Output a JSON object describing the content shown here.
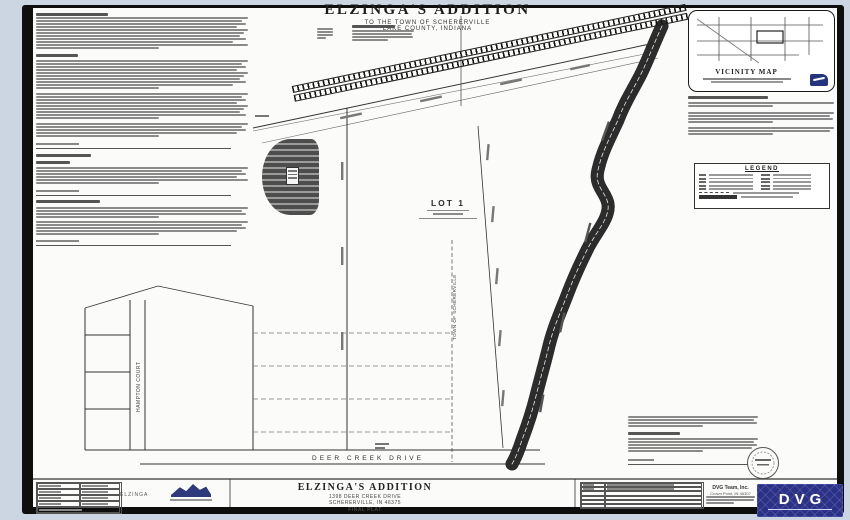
{
  "header": {
    "title": "ELZINGA'S ADDITION",
    "sub1": "TO THE TOWN OF SCHERERVILLE",
    "sub2": "LAKE COUNTY, INDIANA"
  },
  "vicinity": {
    "caption": "VICINITY MAP"
  },
  "legend": {
    "title": "LEGEND",
    "rows_two_col": 5,
    "sample_rows": [
      "dashed-line",
      "solid-bar",
      "symbol-note"
    ]
  },
  "map": {
    "lot1": "LOT 1",
    "town_label": "TOWN OF SCHERERVILLE",
    "hampton": "HAMPTON COURT",
    "deer_creek_drive": "DEER CREEK DRIVE"
  },
  "title_block": {
    "name": "ELZINGA'S ADDITION",
    "address": "1398 DEER CREEK DRIVE",
    "city": "SCHERERVILLE, IN 46375",
    "sheet": "FINAL PLAT",
    "project_label": "ELZINGA",
    "firm_name": "DVG Team, Inc.",
    "firm_city": "Crown Point, IN 46307",
    "logo_text": "DVG"
  },
  "colors": {
    "viewer_bg": "#ccd6e2",
    "scan_edge": "#0e0e0e",
    "page": "#fbfbfa",
    "ink": "#333333",
    "logo_blue": "#2b3187"
  },
  "greek": {
    "left_column": [
      {
        "t": "h",
        "w": 34
      },
      {
        "t": "p",
        "n": 11
      },
      {
        "t": "g",
        "n": 4
      },
      {
        "t": "h",
        "w": 20
      },
      {
        "t": "g",
        "n": 2
      },
      {
        "t": "p",
        "n": 10
      },
      {
        "t": "g",
        "n": 3
      },
      {
        "t": "p",
        "n": 9
      },
      {
        "t": "g",
        "n": 3
      },
      {
        "t": "p",
        "n": 5
      },
      {
        "t": "g",
        "n": 3
      },
      {
        "t": "s"
      },
      {
        "t": "g",
        "n": 3
      },
      {
        "t": "h",
        "w": 26
      },
      {
        "t": "g",
        "n": 3
      },
      {
        "t": "h",
        "w": 16
      },
      {
        "t": "g",
        "n": 2
      },
      {
        "t": "p",
        "n": 6
      },
      {
        "t": "g",
        "n": 3
      },
      {
        "t": "s"
      },
      {
        "t": "g",
        "n": 2
      },
      {
        "t": "h",
        "w": 30
      },
      {
        "t": "g",
        "n": 3
      },
      {
        "t": "p",
        "n": 4
      },
      {
        "t": "g",
        "n": 2
      },
      {
        "t": "p",
        "n": 5
      },
      {
        "t": "g",
        "n": 2
      },
      {
        "t": "s"
      }
    ],
    "vicinity_notes": [
      {
        "t": "h",
        "w": 55
      },
      {
        "t": "g",
        "n": 2
      },
      {
        "t": "p",
        "n": 2
      },
      {
        "t": "g",
        "n": 4
      },
      {
        "t": "p",
        "n": 4
      },
      {
        "t": "g",
        "n": 3
      },
      {
        "t": "p",
        "n": 3
      }
    ],
    "notes_right": [
      {
        "t": "p",
        "n": 4
      },
      {
        "t": "g",
        "n": 4
      },
      {
        "t": "h",
        "w": 40
      },
      {
        "t": "g",
        "n": 2
      },
      {
        "t": "p",
        "n": 5
      },
      {
        "t": "g",
        "n": 4
      },
      {
        "t": "s"
      }
    ],
    "top_labels_a": [
      {
        "t": "p",
        "n": 4
      }
    ],
    "top_labels_b": [
      {
        "t": "h",
        "w": 70
      },
      {
        "t": "g",
        "n": 1
      },
      {
        "t": "p",
        "n": 4
      }
    ],
    "firm_notes": [
      {
        "t": "p",
        "n": 3
      }
    ]
  },
  "tables": {
    "info": {
      "cols": [
        52,
        48
      ],
      "header": true,
      "rows": 3,
      "footer": true
    },
    "revisions": {
      "cols": [
        20,
        80
      ],
      "header": true,
      "rows": 5,
      "filled_rows": 1
    }
  }
}
